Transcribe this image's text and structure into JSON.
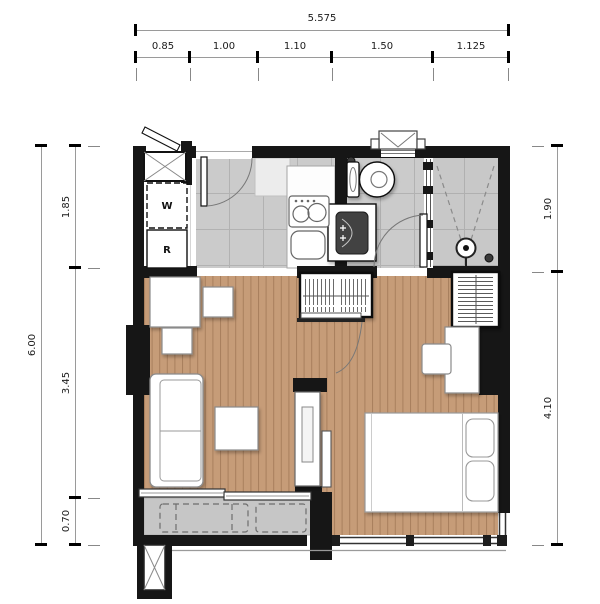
{
  "page": {
    "background": "#ffffff",
    "type": "apartment-floor-plan"
  },
  "dimensions": {
    "top": {
      "total": "5.575",
      "segments": [
        "0.85",
        "1.00",
        "1.10",
        "1.50",
        "1.125"
      ]
    },
    "left": {
      "total": "6.00",
      "segments": [
        "1.85",
        "3.45",
        "0.70"
      ]
    },
    "right": {
      "segments": [
        "1.90",
        "4.10"
      ]
    }
  },
  "plan": {
    "appliances": {
      "washer": "W",
      "refrigerator": "R"
    },
    "rooms": [
      "entry-laundry",
      "kitchen",
      "bathroom",
      "shower",
      "living-area",
      "bedroom",
      "balcony"
    ],
    "colors": {
      "wall": "#161616",
      "wood_floor": "#c69c78",
      "wood_plank_line": "#a87f5d",
      "tile_floor": "#cbcbcb",
      "tile_line": "#b2b2b2",
      "balcony_floor": "#c6c6c6",
      "fixture_outline": "#666666",
      "dimension_text": "#1a1a1a"
    }
  }
}
